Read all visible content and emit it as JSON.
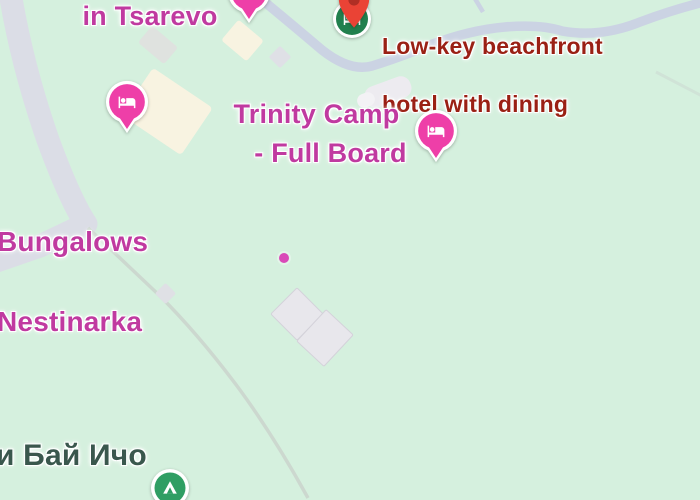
{
  "map": {
    "type": "google-maps-terrain-view",
    "labels": {
      "town_line": "in Tsarevo",
      "hotel_desc": {
        "line1": "Low-key beachfront",
        "line2": "hotel with dining"
      },
      "trinity": {
        "line1": "Trinity Camp",
        "line2": "- Full Board"
      },
      "bungalows": {
        "line1": "Bungalows",
        "line2": "Nestinarka"
      },
      "locality": "и Бай Ичо"
    },
    "markers": {
      "top_lodging_pin": {
        "icon": "bed-icon",
        "shape": "pin",
        "partially_cut": true
      },
      "hotel_result_marker": {
        "icon": "hotel-icon",
        "overlay": "red-location-pin-icon"
      },
      "left_lodging_pin": {
        "icon": "bed-icon",
        "shape": "pin"
      },
      "trinity_lodging_pin": {
        "icon": "bed-icon",
        "shape": "pin"
      },
      "campground_marker": {
        "icon": "tent-icon",
        "shape": "circle"
      },
      "poi_dot": {
        "shape": "dot"
      }
    },
    "colors": {
      "background": "#d5f0de",
      "road_major": "#dbdde6",
      "road_minor": "#cbd3e3",
      "path_minor": "#ccd8cf",
      "building_cream": "#f8f3e1",
      "building_gray": "#e8e7ec",
      "label_pink": "#c03aa0",
      "label_red": "#9a2014",
      "label_locality": "#3a574d",
      "marker_pink": "#ee3fa8",
      "marker_green": "#2f9e63",
      "marker_green_dark": "#22804e",
      "pin_red": "#ea4335",
      "pin_red_dark": "#b02e24",
      "poi_dot": "#d94ab8",
      "white": "#ffffff"
    }
  }
}
